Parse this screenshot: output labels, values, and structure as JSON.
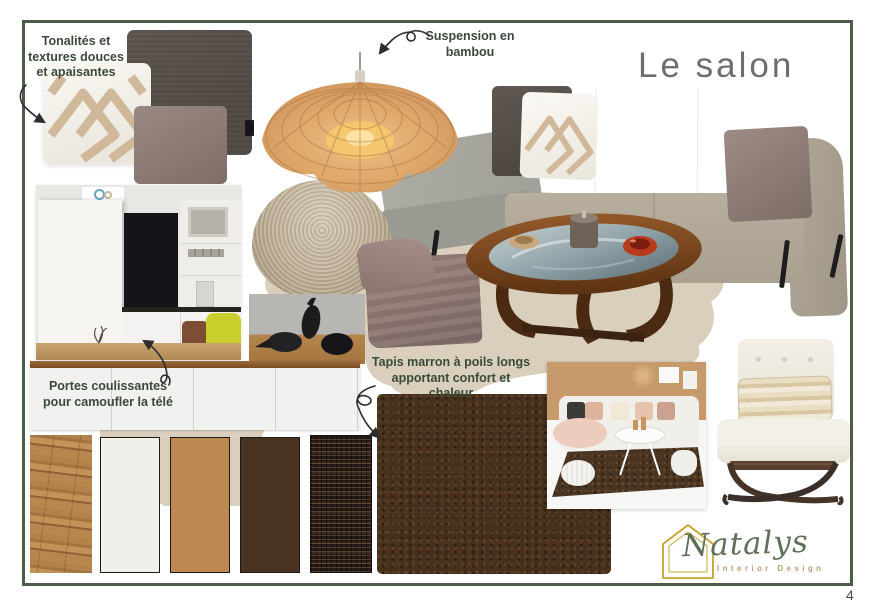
{
  "page": {
    "title": "Le salon",
    "number": "4"
  },
  "annotations": {
    "pillows": "Tonalités et\ntextures douces\net apaisantes",
    "lamp": "Suspension en\nbambou",
    "tv": "Portes coulissantes\npour camoufler la télé",
    "rug": "Tapis marron à poils longs\napportant confort et chaleur"
  },
  "logo": {
    "brand": "Natalys",
    "subtitle": "Interior Design"
  },
  "colors": {
    "frame_green": "#4d5b49",
    "annotation_green": "#3a4a38",
    "title_grey": "#6e6e6e",
    "blob_beige": "#d9cfbc",
    "rug_brown": "#452f1d",
    "swatch_offwhite": "#f0efea",
    "swatch_camel": "#bd8851",
    "swatch_dark_brown": "#4a3421",
    "logo_gold": "#c9a22c",
    "logo_green": "#5e7055",
    "logo_tan": "#c39a78"
  },
  "materials": [
    "wood-floor",
    "off-white",
    "camel",
    "dark-brown",
    "woven-rattan"
  ]
}
